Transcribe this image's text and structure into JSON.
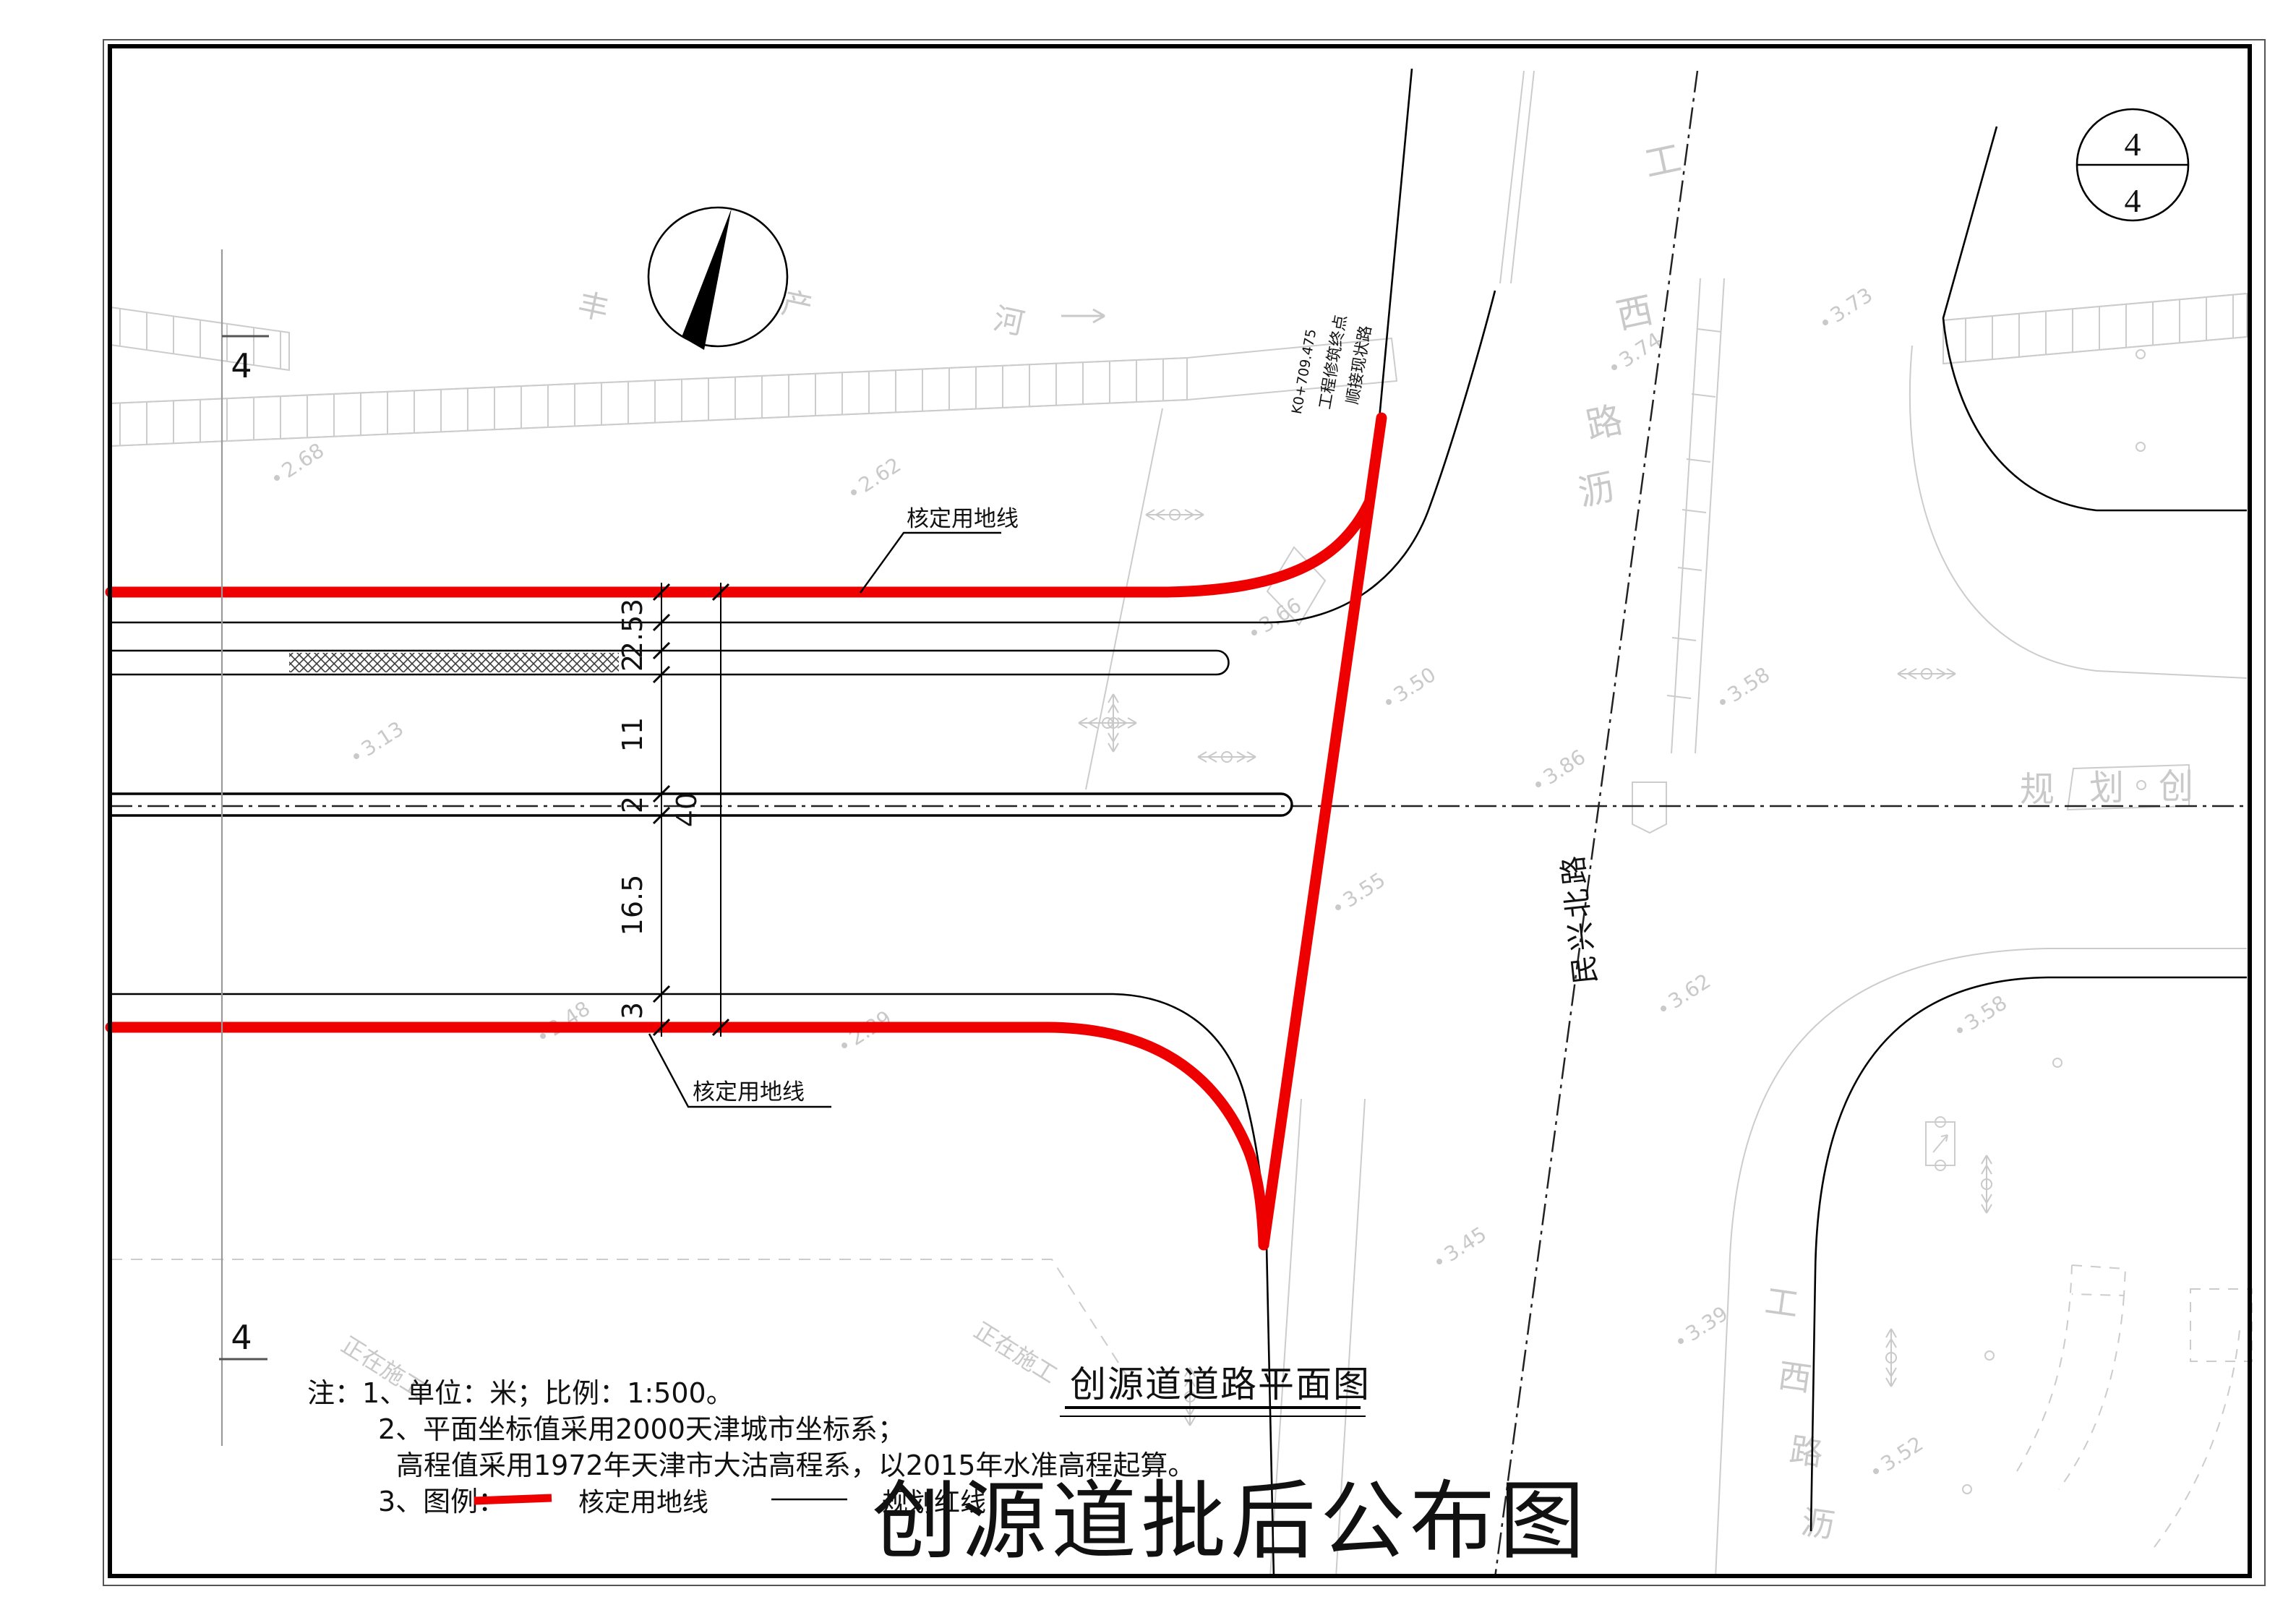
{
  "sheet_badge": {
    "top": "4",
    "bottom": "4"
  },
  "matchline": {
    "top": "4",
    "bottom": "4"
  },
  "terminus": {
    "station": "K0+709.475",
    "line2": "工程修筑终点",
    "line3": "顺接现状路"
  },
  "plan_labels": {
    "approved_top": "核定用地线",
    "approved_bottom": "核定用地线",
    "minxing_road": "民兴北路",
    "river_char1": "丰",
    "river_char2": "产",
    "river_char3": "河",
    "gongxi_top": {
      "c1": "工",
      "c2": "西",
      "c3": "路",
      "c4": "沥"
    },
    "gongxi_bottom": {
      "c1": "工",
      "c2": "西",
      "c3": "路",
      "c4": "沥"
    },
    "planning_strip": {
      "c1": "规",
      "c2": "划",
      "c3": "创"
    },
    "construction_left": "正在施工",
    "construction_right": "正在施工"
  },
  "dimensions": {
    "segments": [
      {
        "v": "3"
      },
      {
        "v": "2.5"
      },
      {
        "v": "2"
      },
      {
        "v": "11"
      },
      {
        "v": "2"
      },
      {
        "v": "16.5"
      },
      {
        "v": "3"
      }
    ],
    "total": "40"
  },
  "elevations": [
    {
      "v": "2.68"
    },
    {
      "v": "2.62"
    },
    {
      "v": "3.13"
    },
    {
      "v": "2.48"
    },
    {
      "v": "2.29"
    },
    {
      "v": "3.74"
    },
    {
      "v": "3.73"
    },
    {
      "v": "3.50"
    },
    {
      "v": "3.58"
    },
    {
      "v": "3.86"
    },
    {
      "v": "3.55"
    },
    {
      "v": "3.62"
    },
    {
      "v": "3.66"
    },
    {
      "v": "3.45"
    },
    {
      "v": "3.39"
    },
    {
      "v": "3.52"
    },
    {
      "v": "3.58"
    }
  ],
  "notes": {
    "line1": "注：1、单位：米；比例：1:500。",
    "line2": "2、平面坐标值采用2000天津城市坐标系；",
    "line3": "高程值采用1972年天津市大沽高程系，以2015年水准高程起算。",
    "line4_prefix": "3、图例："
  },
  "legend": {
    "red_label": "核定用地线",
    "black_label": "规划红线"
  },
  "titles": {
    "plan_title": "创源道道路平面图",
    "main_title": "创源道批后公布图"
  },
  "colors": {
    "approved_red": "#EE0000",
    "planning_black": "#000000",
    "faint_gray": "#CACACA"
  }
}
